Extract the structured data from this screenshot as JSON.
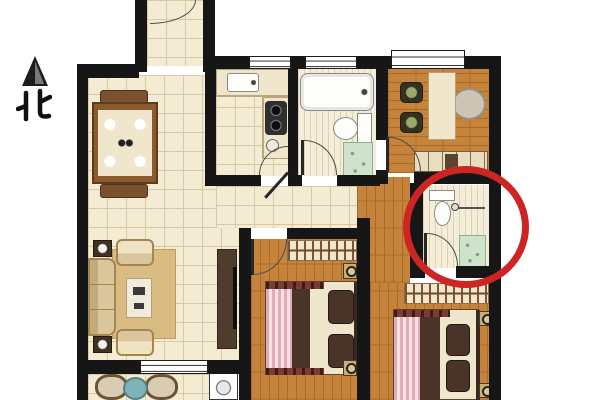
{
  "compass": {
    "label": "北",
    "meaning": "North",
    "style": "black triangle arrow above character"
  },
  "colors": {
    "wall": "#161616",
    "tile": "#f4ebd3",
    "tile_line": "#d9c9a4",
    "wood": "#c5833c",
    "wood_line": "#a96b26",
    "stripe": "#f3edda",
    "stripe_line": "#ddd2b2",
    "accent_red": "#cd2424",
    "rug": "#d8bc82",
    "cream": "#efe6cb",
    "cream_border": "#b3a177",
    "dark_wood": "#4e3c2c",
    "bed_dark": "#4a3328",
    "pink": "#e2abb8",
    "pink_light": "#f4e2e4",
    "fringe": "#7c3c31",
    "green": "#cfe2cb",
    "green_border": "#8fae8c",
    "teal": "#7fb3ba",
    "fixture_border": "#8a8a8a",
    "arc": "#4d4d4d",
    "leaf": "#262626",
    "knob": "#2c2217"
  },
  "floor_plan": {
    "annotation": {
      "shape": "ellipse",
      "color": "#cd2424",
      "stroke_px": 7,
      "center_x": 466,
      "center_y": 227,
      "rx": 63,
      "ry": 61,
      "highlights": "ensuite-bathroom"
    },
    "rooms": [
      {
        "id": "entry-hall",
        "floor": "tile",
        "features": [
          "entry-door-arc-at-top"
        ]
      },
      {
        "id": "dining-area",
        "floor": "tile",
        "furniture": [
          "ornate-dining-table",
          "four-chairs",
          "place-settings"
        ]
      },
      {
        "id": "kitchen",
        "floor": "tile",
        "furniture": [
          "l-shaped-counter",
          "sink",
          "two-burner-stove",
          "door-to-hallway"
        ]
      },
      {
        "id": "shared-bathroom",
        "floor": "stripe-tile",
        "furniture": [
          "bathtub",
          "toilet",
          "shower-corner",
          "door"
        ]
      },
      {
        "id": "study",
        "floor": "wood",
        "furniture": [
          "desk",
          "two-chairs",
          "round-lounge-chair",
          "sideboard",
          "window",
          "door"
        ]
      },
      {
        "id": "ensuite-bathroom",
        "floor": "stripe-tile",
        "furniture": [
          "toilet",
          "towel-bar",
          "shower-corner",
          "door-to-master"
        ],
        "highlighted": true
      },
      {
        "id": "living-room",
        "floor": "tile",
        "furniture": [
          "sofa",
          "two-armchairs",
          "two-lamp-side-tables",
          "coffee-table",
          "rug",
          "tv-cabinet",
          "wall-tv"
        ]
      },
      {
        "id": "hallway",
        "floor": "tile",
        "features": [
          "connects-kitchen-bathroom-bedrooms"
        ]
      },
      {
        "id": "middle-bedroom",
        "floor": "wood",
        "furniture": [
          "wardrobe-with-hangers",
          "double-bed-striped-throw",
          "two-nightstands",
          "door"
        ]
      },
      {
        "id": "master-bedroom",
        "floor": "wood",
        "furniture": [
          "wardrobe-with-hangers",
          "double-bed-striped-throw",
          "two-nightstands"
        ]
      },
      {
        "id": "balcony",
        "floor": "tile",
        "furniture": [
          "two-rattan-chairs",
          "round-teal-table",
          "washing-machine"
        ],
        "features": [
          "sliding-window-to-living-room"
        ]
      }
    ]
  }
}
